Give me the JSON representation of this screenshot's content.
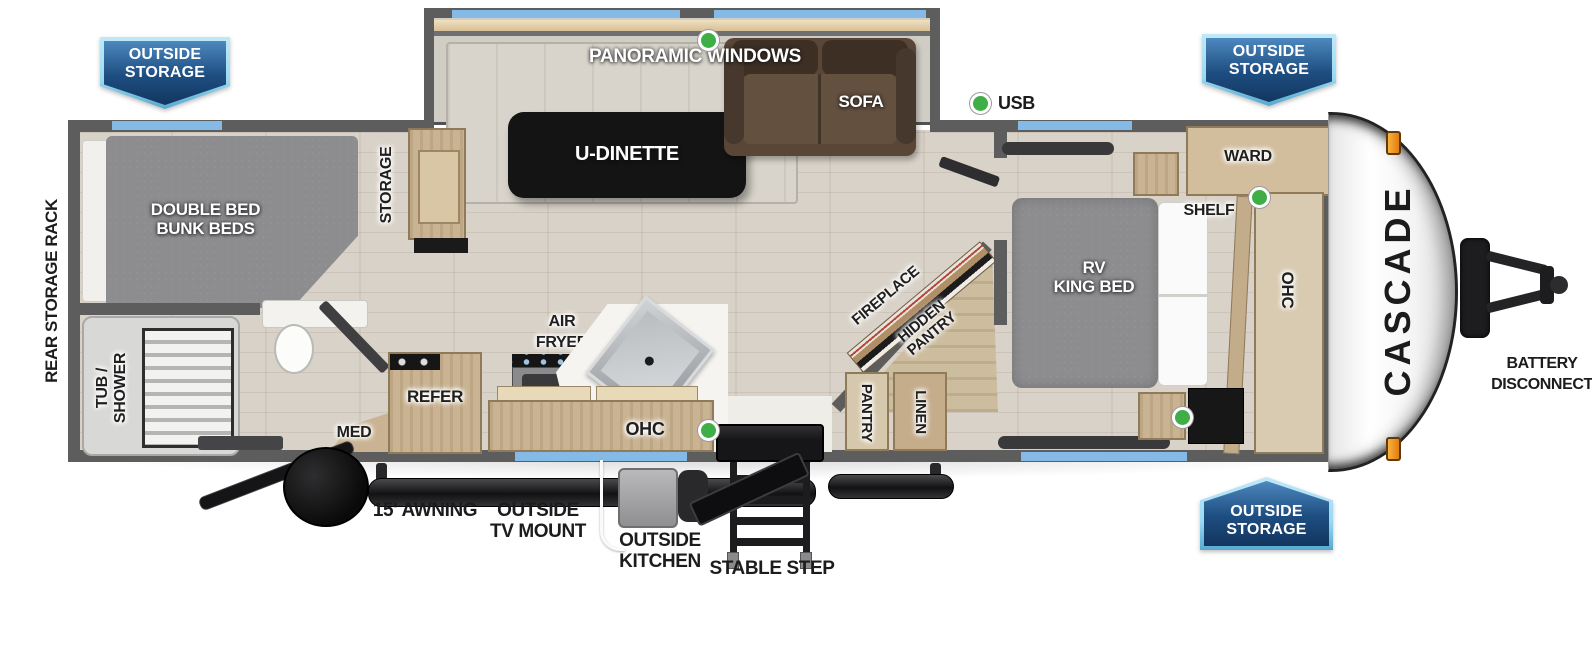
{
  "title": "Cascade travel trailer floor plan",
  "brand": "CASCADE",
  "badge": {
    "line1": "OUTSIDE",
    "line2": "STORAGE"
  },
  "exterior": {
    "rear_storage_rack": "REAR STORAGE RACK",
    "usb": "USB",
    "panoramic_windows": "PANORAMIC WINDOWS",
    "awning": "15' AWNING",
    "tv_mount_line1": "OUTSIDE",
    "tv_mount_line2": "TV MOUNT",
    "outside_kitchen_line1": "OUTSIDE",
    "outside_kitchen_line2": "KITCHEN",
    "stable_step": "STABLE STEP",
    "battery_line1": "BATTERY",
    "battery_line2": "DISCONNECT"
  },
  "interior": {
    "dinette": "U-DINETTE",
    "sofa": "SOFA",
    "bunk_line1": "DOUBLE BED",
    "bunk_line2": "BUNK BEDS",
    "storage": "STORAGE",
    "tub_line1": "TUB /",
    "tub_line2": "SHOWER",
    "med": "MED",
    "refer": "REFER",
    "air_fryer_line1": "AIR",
    "air_fryer_line2": "FRYER",
    "ohc_kitchen": "OHC",
    "fireplace": "FIREPLACE",
    "hidden_pantry_line1": "HIDDEN",
    "hidden_pantry_line2": "PANTRY",
    "pantry": "PANTRY",
    "linen": "LINEN",
    "ward": "WARD",
    "shelf": "SHELF",
    "king_line1": "RV",
    "king_line2": "KING BED",
    "ohc_bedroom": "OHC"
  },
  "colors": {
    "wall": "#5d5d5d",
    "floor": "#d9d2c8",
    "wood": "#c9b392",
    "window_accent": "#85b9e6",
    "indicator_green": "#3fae47",
    "badge_top": "#4d88be",
    "badge_bottom": "#12365f",
    "badge_border": "#9bd9f2",
    "sofa_brown": "#5a4636",
    "bed_gray": "#8d8d90"
  }
}
